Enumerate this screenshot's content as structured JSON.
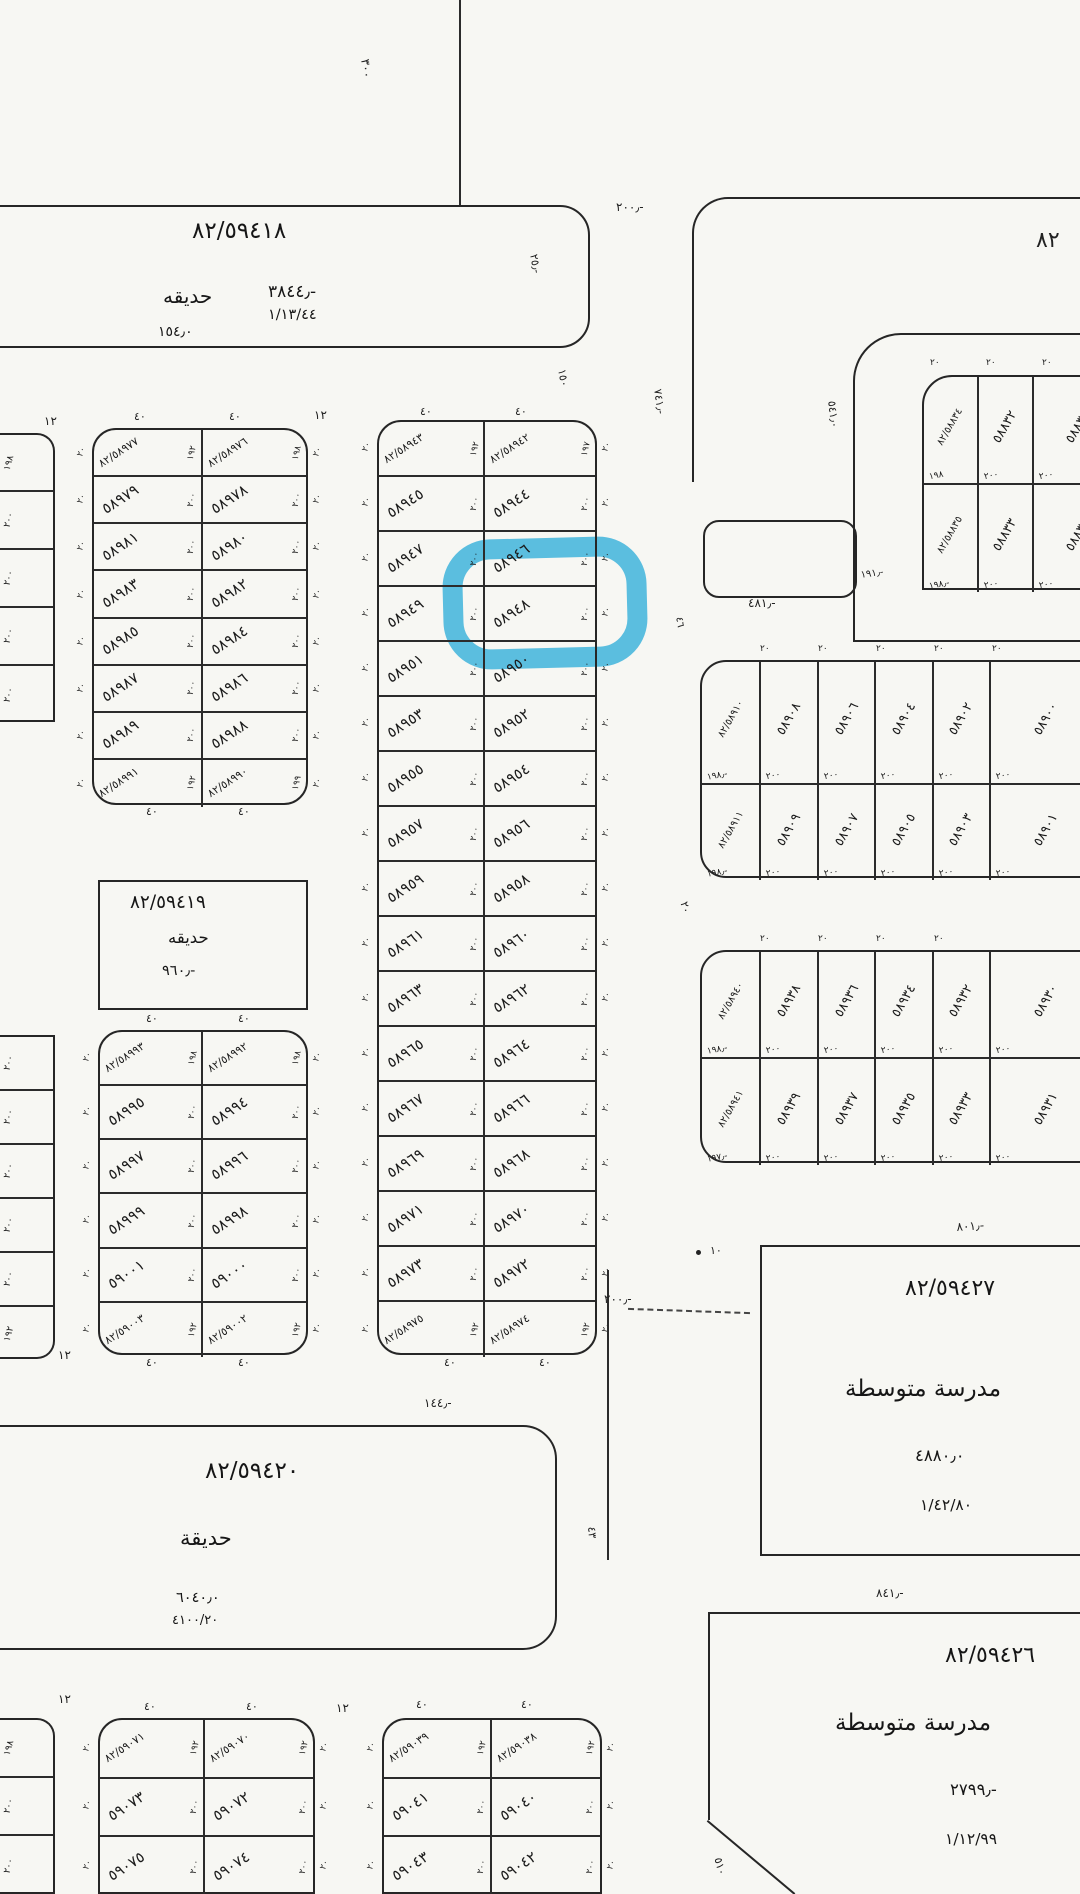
{
  "highlight": {
    "plot": "٥٨٩٤٨",
    "color": "#3ab7e6"
  },
  "blocks": {
    "garden_top": {
      "id": "٨٢/٥٩٤١٨",
      "name": "حديقه",
      "area": "٣٨٤٤٫-",
      "ref": "١/١٣/٤٤",
      "dim": "١٥٤٫٠"
    },
    "garden_mid": {
      "id": "٨٢/٥٩٤١٩",
      "name": "حديقه",
      "area": "٩٦٠٫-"
    },
    "garden_bottom": {
      "id": "٨٢/٥٩٤٢٠",
      "name": "حديقة",
      "area": "٦٠٤٠٫٠",
      "ref": "٤١٠٠/٢٠"
    },
    "school_1": {
      "id": "٨٢/٥٩٤٢٧",
      "name": "مدرسة متوسطة",
      "area": "٤٨٨٠٫٠",
      "ref": "١/٤٢/٨٠"
    },
    "school_2": {
      "id": "٨٢/٥٩٤٢٦",
      "name": "مدرسة متوسطة",
      "area": "٢٧٩٩٫-",
      "ref": "١/١٢/٩٩"
    }
  },
  "grids": {
    "left_upper": {
      "rows": [
        {
          "cells": [
            {
              "n": "٨٢/٥٨٩٧٧",
              "d": "١٩٢",
              "c": true
            },
            {
              "n": "٨٢/٥٨٩٧٦",
              "d": "١٩٨",
              "c": true
            }
          ]
        },
        {
          "cells": [
            {
              "n": "٥٨٩٧٩",
              "d": "٢٠٠"
            },
            {
              "n": "٥٨٩٧٨",
              "d": "٢٠٠"
            }
          ]
        },
        {
          "cells": [
            {
              "n": "٥٨٩٨١",
              "d": "٢٠٠"
            },
            {
              "n": "٥٨٩٨٠",
              "d": "٢٠٠"
            }
          ]
        },
        {
          "cells": [
            {
              "n": "٥٨٩٨٣",
              "d": "٢٠٠"
            },
            {
              "n": "٥٨٩٨٢",
              "d": "٢٠٠"
            }
          ]
        },
        {
          "cells": [
            {
              "n": "٥٨٩٨٥",
              "d": "٢٠٠"
            },
            {
              "n": "٥٨٩٨٤",
              "d": "٢٠٠"
            }
          ]
        },
        {
          "cells": [
            {
              "n": "٥٨٩٨٧",
              "d": "٢٠٠"
            },
            {
              "n": "٥٨٩٨٦",
              "d": "٢٠٠"
            }
          ]
        },
        {
          "cells": [
            {
              "n": "٥٨٩٨٩",
              "d": "٢٠٠"
            },
            {
              "n": "٥٨٩٨٨",
              "d": "٢٠٠"
            }
          ]
        },
        {
          "cells": [
            {
              "n": "٨٢/٥٨٩٩١",
              "d": "١٩٢",
              "c": true
            },
            {
              "n": "٨٢/٥٨٩٩٠",
              "d": "١٩٩",
              "c": true
            }
          ]
        }
      ]
    },
    "left_lower": {
      "rows": [
        {
          "cells": [
            {
              "n": "٨٢/٥٨٩٩٣",
              "d": "١٩٨",
              "c": true
            },
            {
              "n": "٨٢/٥٨٩٩٢",
              "d": "١٩٨",
              "c": true
            }
          ]
        },
        {
          "cells": [
            {
              "n": "٥٨٩٩٥",
              "d": "٢٠٠"
            },
            {
              "n": "٥٨٩٩٤",
              "d": "٢٠٠"
            }
          ]
        },
        {
          "cells": [
            {
              "n": "٥٨٩٩٧",
              "d": "٢٠٠"
            },
            {
              "n": "٥٨٩٩٦",
              "d": "٢٠٠"
            }
          ]
        },
        {
          "cells": [
            {
              "n": "٥٨٩٩٩",
              "d": "٢٠٠"
            },
            {
              "n": "٥٨٩٩٨",
              "d": "٢٠٠"
            }
          ]
        },
        {
          "cells": [
            {
              "n": "٥٩٠٠١",
              "d": "٢٠٠"
            },
            {
              "n": "٥٩٠٠٠",
              "d": "٢٠٠"
            }
          ]
        },
        {
          "cells": [
            {
              "n": "٨٢/٥٩٠٠٣",
              "d": "١٩٢",
              "c": true
            },
            {
              "n": "٨٢/٥٩٠٠٢",
              "d": "١٩٢",
              "c": true
            }
          ]
        }
      ]
    },
    "middle": {
      "rows": [
        {
          "cells": [
            {
              "n": "٨٢/٥٨٩٤٣",
              "d": "١٩٢",
              "c": true
            },
            {
              "n": "٨٢/٥٨٩٤٢",
              "d": "١٩٧",
              "c": true
            }
          ]
        },
        {
          "cells": [
            {
              "n": "٥٨٩٤٥",
              "d": "٢٠٠"
            },
            {
              "n": "٥٨٩٤٤",
              "d": "٢٠٠"
            }
          ]
        },
        {
          "cells": [
            {
              "n": "٥٨٩٤٧",
              "d": "٢٠٠"
            },
            {
              "n": "٥٨٩٤٦",
              "d": "٢٠٠"
            }
          ]
        },
        {
          "cells": [
            {
              "n": "٥٨٩٤٩",
              "d": "٢٠٠"
            },
            {
              "n": "٥٨٩٤٨",
              "d": "٢٠٠",
              "hl": true
            }
          ]
        },
        {
          "cells": [
            {
              "n": "٥٨٩٥١",
              "d": "٢٠٠"
            },
            {
              "n": "٥٨٩٥٠",
              "d": "٢٠٠"
            }
          ]
        },
        {
          "cells": [
            {
              "n": "٥٨٩٥٣",
              "d": "٢٠٠"
            },
            {
              "n": "٥٨٩٥٢",
              "d": "٢٠٠"
            }
          ]
        },
        {
          "cells": [
            {
              "n": "٥٨٩٥٥",
              "d": "٢٠٠"
            },
            {
              "n": "٥٨٩٥٤",
              "d": "٢٠٠"
            }
          ]
        },
        {
          "cells": [
            {
              "n": "٥٨٩٥٧",
              "d": "٢٠٠"
            },
            {
              "n": "٥٨٩٥٦",
              "d": "٢٠٠"
            }
          ]
        },
        {
          "cells": [
            {
              "n": "٥٨٩٥٩",
              "d": "٢٠٠"
            },
            {
              "n": "٥٨٩٥٨",
              "d": "٢٠٠"
            }
          ]
        },
        {
          "cells": [
            {
              "n": "٥٨٩٦١",
              "d": "٢٠٠"
            },
            {
              "n": "٥٨٩٦٠",
              "d": "٢٠٠"
            }
          ]
        },
        {
          "cells": [
            {
              "n": "٥٨٩٦٣",
              "d": "٢٠٠"
            },
            {
              "n": "٥٨٩٦٢",
              "d": "٢٠٠"
            }
          ]
        },
        {
          "cells": [
            {
              "n": "٥٨٩٦٥",
              "d": "٢٠٠"
            },
            {
              "n": "٥٨٩٦٤",
              "d": "٢٠٠"
            }
          ]
        },
        {
          "cells": [
            {
              "n": "٥٨٩٦٧",
              "d": "٢٠٠"
            },
            {
              "n": "٥٨٩٦٦",
              "d": "٢٠٠"
            }
          ]
        },
        {
          "cells": [
            {
              "n": "٥٨٩٦٩",
              "d": "٢٠٠"
            },
            {
              "n": "٥٨٩٦٨",
              "d": "٢٠٠"
            }
          ]
        },
        {
          "cells": [
            {
              "n": "٥٨٩٧١",
              "d": "٢٠٠"
            },
            {
              "n": "٥٨٩٧٠",
              "d": "٢٠٠"
            }
          ]
        },
        {
          "cells": [
            {
              "n": "٥٨٩٧٣",
              "d": "٢٠٠"
            },
            {
              "n": "٥٨٩٧٢",
              "d": "٢٠٠"
            }
          ]
        },
        {
          "cells": [
            {
              "n": "٨٢/٥٨٩٧٥",
              "d": "١٩٢",
              "c": true
            },
            {
              "n": "٨٢/٥٨٩٧٤",
              "d": "١٩٢",
              "c": true
            }
          ]
        }
      ]
    },
    "top_right": {
      "rows": [
        {
          "cells": [
            {
              "n": "٨٢/٥٨٨٣٤",
              "d": "١٩٨",
              "c": true
            },
            {
              "n": "٥٨٨٣٢",
              "d": "٢٠٠"
            },
            {
              "n": "٥٨٨٣٠",
              "d": "٢٠٠"
            }
          ]
        },
        {
          "cells": [
            {
              "n": "٨٢/٥٨٨٣٥",
              "d": "١٩٨٫-",
              "c": true
            },
            {
              "n": "٥٨٨٣٣",
              "d": "٢٠٠"
            },
            {
              "n": "٥٨٨٣١",
              "d": "٢٠٠"
            }
          ]
        }
      ]
    },
    "right_a": {
      "rows": [
        {
          "cells": [
            {
              "n": "٨٢/٥٨٩١٠",
              "d": "١٩٨٫-",
              "c": true
            },
            {
              "n": "٥٨٩٠٨",
              "d": "٢٠٠"
            },
            {
              "n": "٥٨٩٠٦",
              "d": "٢٠٠"
            },
            {
              "n": "٥٨٩٠٤",
              "d": "٢٠٠"
            },
            {
              "n": "٥٨٩٠٢",
              "d": "٢٠٠"
            },
            {
              "n": "٥٨٩٠٠",
              "d": "٢٠٠"
            }
          ]
        },
        {
          "cells": [
            {
              "n": "٨٢/٥٨٩١١",
              "d": "١٩٨٫-",
              "c": true
            },
            {
              "n": "٥٨٩٠٩",
              "d": "٢٠٠"
            },
            {
              "n": "٥٨٩٠٧",
              "d": "٢٠٠"
            },
            {
              "n": "٥٨٩٠٥",
              "d": "٢٠٠"
            },
            {
              "n": "٥٨٩٠٣",
              "d": "٢٠٠"
            },
            {
              "n": "٥٨٩٠١",
              "d": "٢٠٠"
            }
          ]
        }
      ]
    },
    "right_b": {
      "rows": [
        {
          "cells": [
            {
              "n": "٨٢/٥٨٩٤٠",
              "d": "١٩٨٫-",
              "c": true
            },
            {
              "n": "٥٨٩٣٨",
              "d": "٢٠٠"
            },
            {
              "n": "٥٨٩٣٦",
              "d": "٢٠٠"
            },
            {
              "n": "٥٨٩٣٤",
              "d": "٢٠٠"
            },
            {
              "n": "٥٨٩٣٢",
              "d": "٢٠٠"
            },
            {
              "n": "٥٨٩٣٠",
              "d": "٢٠٠"
            }
          ]
        },
        {
          "cells": [
            {
              "n": "٨٢/٥٨٩٤١",
              "d": "١٩٧٫-",
              "c": true
            },
            {
              "n": "٥٨٩٣٩",
              "d": "٢٠٠"
            },
            {
              "n": "٥٨٩٣٧",
              "d": "٢٠٠"
            },
            {
              "n": "٥٨٩٣٥",
              "d": "٢٠٠"
            },
            {
              "n": "٥٨٩٣٣",
              "d": "٢٠٠"
            },
            {
              "n": "٥٨٩٣١",
              "d": "٢٠٠"
            }
          ]
        }
      ]
    },
    "bottom_a": {
      "rows": [
        {
          "cells": [
            {
              "n": "٨٢/٥٩٠٧١",
              "d": "١٩٢",
              "c": true
            },
            {
              "n": "٨٢/٥٩٠٧٠",
              "d": "١٩٢",
              "c": true
            }
          ]
        },
        {
          "cells": [
            {
              "n": "٥٩٠٧٣",
              "d": "٢٠٠"
            },
            {
              "n": "٥٩٠٧٢",
              "d": "٢٠٠"
            }
          ]
        },
        {
          "cells": [
            {
              "n": "٥٩٠٧٥",
              "d": "٢٠٠"
            },
            {
              "n": "٥٩٠٧٤",
              "d": "٢٠٠"
            }
          ]
        }
      ]
    },
    "bottom_b": {
      "rows": [
        {
          "cells": [
            {
              "n": "٨٢/٥٩٠٣٩",
              "d": "١٩٢",
              "c": true
            },
            {
              "n": "٨٢/٥٩٠٣٨",
              "d": "١٩٢",
              "c": true
            }
          ]
        },
        {
          "cells": [
            {
              "n": "٥٩٠٤١",
              "d": "٢٠٠"
            },
            {
              "n": "٥٩٠٤٠",
              "d": "٢٠٠"
            }
          ]
        },
        {
          "cells": [
            {
              "n": "٥٩٠٤٣",
              "d": "٢٠٠"
            },
            {
              "n": "٥٩٠٤٢",
              "d": "٢٠٠"
            }
          ]
        }
      ]
    }
  },
  "strips": {
    "top": {
      "cells": [
        "١٩٨",
        "٢٠٠",
        "٢٠٠",
        "٢٠٠",
        "٢٠٠"
      ]
    },
    "lower": {
      "cells": [
        "٢٠٠",
        "٢٠٠",
        "٢٠٠",
        "٢٠٠",
        "٢٠٠",
        "١٩٢"
      ]
    },
    "bottom": {
      "cells": [
        "١٩٨",
        "٢٠٠",
        "٢٠٠"
      ]
    }
  },
  "dims": {
    "v300": "٣٠٠",
    "t200": "٢٠٠٫-",
    "v25": "٢٥٫-",
    "blk82": "٨٢",
    "v741": "٧٤١٫-",
    "v541": "٥٤١٫٠",
    "v150": "١٥٠",
    "a481": "٤٨١٫-",
    "a191": "١٩١٫-",
    "tick20": "٢٠",
    "v46": "٤٦",
    "a801": "٨٠١٫-",
    "s200": "٢٠٠٫-",
    "a10": "١٠",
    "v43": "٤٣",
    "a841": "٨٤١٫-",
    "a144": "١٤٤٫-",
    "st12": "١٢",
    "w40": "٤٠",
    "v510": "٥١٠"
  },
  "misc": {
    "row_tick": "٢٠"
  }
}
